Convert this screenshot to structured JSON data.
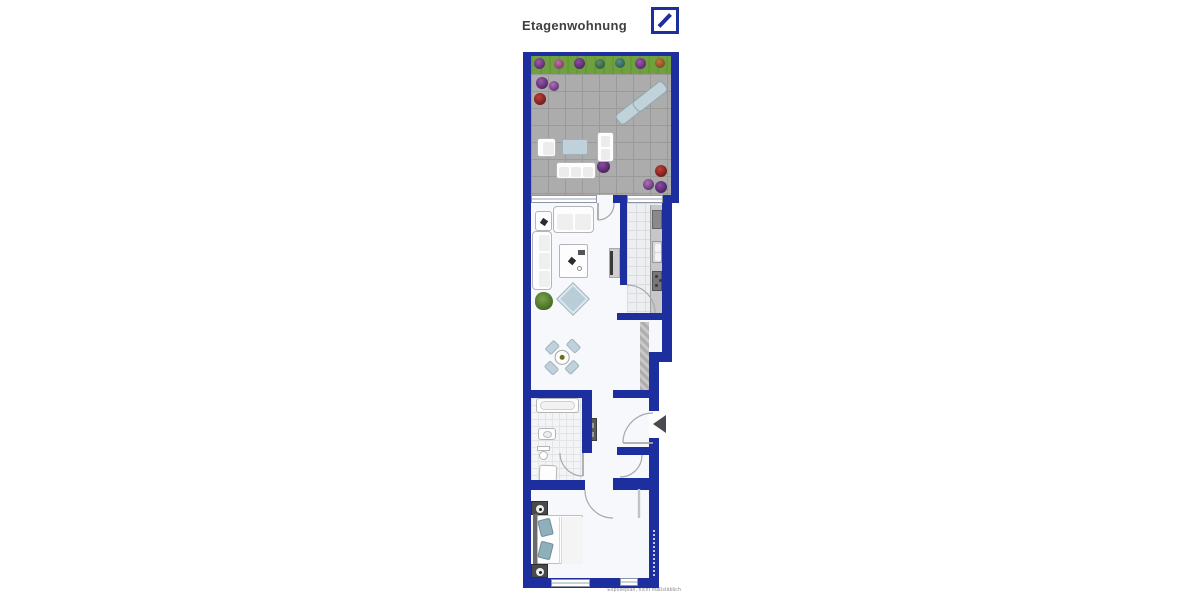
{
  "header": {
    "title": "Etagenwohnung"
  },
  "logo": {
    "name": "deutsche-bank-logo",
    "color": "#1c2f9c"
  },
  "caption": {
    "text": "Exposéplan, nicht maßstäblich"
  },
  "colors": {
    "wall": "#1d2f9e",
    "grass": "#6fa23e",
    "terrace_floor": "#acacac",
    "interior": "#f6f8fb",
    "furniture_accent": "#bfd1db",
    "kitchen_tile": "#eceef0",
    "entry_arrow": "#4a4a50"
  }
}
